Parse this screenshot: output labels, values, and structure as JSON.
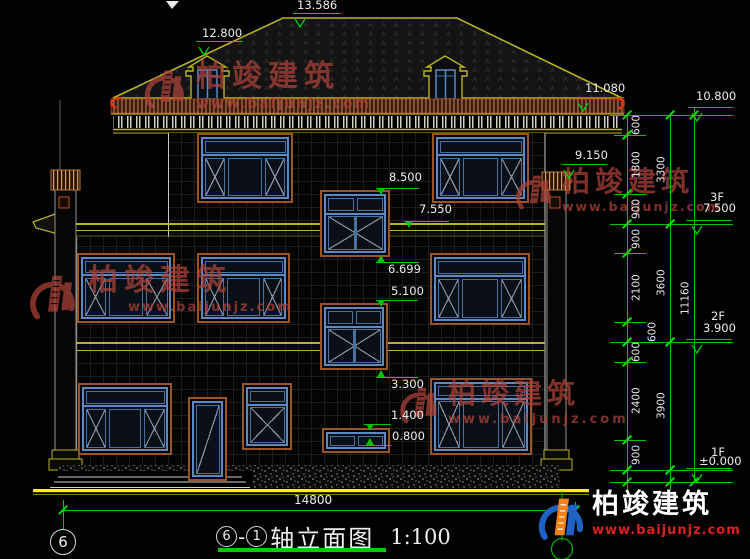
{
  "drawing": {
    "type": "architectural front elevation",
    "scale_note": "1:100"
  },
  "watermark": {
    "company": "柏竣建筑",
    "website": "www.baijunjz.com"
  },
  "logo": {
    "company": "柏竣建筑",
    "website": "www.baijunjz.com"
  },
  "title_block": {
    "axis_start": "6",
    "separator": "-",
    "axis_end": "1",
    "title": "轴立面图",
    "scale": "1:100"
  },
  "axis_bubble": {
    "label": "6"
  },
  "bottom_dimension": {
    "value": "14800"
  },
  "colors": {
    "dimension_green": "#00c400",
    "text_white": "#ededed",
    "band_yellow": "#b9b325",
    "ground_yellow": "#ffee00",
    "frame_brown": "#9a5526",
    "frame_blue": "#5d8ac2",
    "watermark_red": "#b04338",
    "fascia_red": "#d93511",
    "logo_orange": "#f28018",
    "logo_blue": "#1f62c4"
  },
  "elevation_labels": [
    {
      "value": "13.586",
      "tx": 297,
      "ty": 0,
      "x1": 293,
      "x2": 341,
      "y": 13,
      "mx": 300,
      "marker": "open"
    },
    {
      "value": "12.800",
      "tx": 202,
      "ty": 28,
      "x1": 196,
      "x2": 243,
      "y": 41,
      "mx": 204,
      "marker": "open"
    },
    {
      "value": "11.080",
      "tx": 585,
      "ty": 83,
      "x1": 576,
      "x2": 624,
      "y": 97,
      "mx": 583,
      "marker": "open"
    },
    {
      "value": "9.150",
      "tx": 575,
      "ty": 150,
      "x1": 562,
      "x2": 607,
      "y": 164,
      "mx": 569,
      "marker": "open"
    },
    {
      "value": "8.500",
      "tx": 389,
      "ty": 172,
      "x1": 376,
      "x2": 419,
      "y": 188,
      "mx": 381,
      "marker": "down"
    },
    {
      "value": "7.550",
      "tx": 419,
      "ty": 204,
      "x1": 404,
      "x2": 449,
      "y": 221,
      "mx": 409,
      "marker": "down"
    },
    {
      "value": "6.699",
      "tx": 388,
      "ty": 264,
      "x1": 376,
      "x2": 419,
      "y": 262,
      "mx": 381,
      "marker": "up"
    },
    {
      "value": "5.100",
      "tx": 391,
      "ty": 286,
      "x1": 376,
      "x2": 418,
      "y": 300,
      "mx": 381,
      "marker": "down"
    },
    {
      "value": "3.300",
      "tx": 391,
      "ty": 379,
      "x1": 376,
      "x2": 418,
      "y": 377,
      "mx": 381,
      "marker": "up"
    },
    {
      "value": "1.400",
      "tx": 391,
      "ty": 410,
      "x1": 364,
      "x2": 391,
      "y": 424,
      "mx": 370,
      "marker": "down"
    },
    {
      "value": "0.800",
      "tx": 392,
      "ty": 431,
      "x1": 364,
      "x2": 391,
      "y": 445,
      "mx": 370,
      "marker": "up"
    }
  ],
  "level_markers": [
    {
      "floor": "",
      "value": "10.800",
      "fx": 0,
      "fy": 0,
      "tx": 696,
      "ty": 91,
      "x1": 688,
      "x2": 733,
      "y": 107,
      "mx": 697
    },
    {
      "floor": "3F",
      "value": "7.500",
      "fx": 710,
      "fy": 190,
      "tx": 703,
      "ty": 203,
      "x1": 686,
      "x2": 732,
      "y": 220,
      "mx": 697
    },
    {
      "floor": "2F",
      "value": "3.900",
      "fx": 711,
      "fy": 309,
      "tx": 703,
      "ty": 323,
      "x1": 686,
      "x2": 732,
      "y": 339,
      "mx": 697
    },
    {
      "floor": "1F",
      "value": "±0.000",
      "fx": 711,
      "fy": 445,
      "tx": 699,
      "ty": 456,
      "x1": 686,
      "x2": 732,
      "y": 468,
      "mx": 697
    }
  ],
  "floor_lines": [
    115,
    224,
    342,
    470,
    482
  ],
  "dimension_chains": [
    {
      "x": 627,
      "label_x": 630,
      "top": 115,
      "bottom": 490,
      "segments": [
        {
          "label": "600",
          "y1": 115,
          "y2": 135
        },
        {
          "label": "1800",
          "y1": 135,
          "y2": 194
        },
        {
          "label": "900",
          "y1": 194,
          "y2": 224
        },
        {
          "label": "900",
          "y1": 224,
          "y2": 253
        },
        {
          "label": "2100",
          "y1": 253,
          "y2": 322
        },
        {
          "label": "600",
          "y1": 322,
          "y2": 342,
          "lx": 646
        },
        {
          "label": "600",
          "y1": 342,
          "y2": 362
        },
        {
          "label": "2400",
          "y1": 362,
          "y2": 440
        },
        {
          "label": "900",
          "y1": 440,
          "y2": 470
        },
        {
          "label": "",
          "y1": 470,
          "y2": 482
        }
      ]
    },
    {
      "x": 670,
      "label_x": 655,
      "top": 115,
      "bottom": 490,
      "segments": [
        {
          "label": "3300",
          "y1": 115,
          "y2": 224
        },
        {
          "label": "3600",
          "y1": 224,
          "y2": 342
        },
        {
          "label": "3900",
          "y1": 342,
          "y2": 470
        },
        {
          "label": "",
          "y1": 470,
          "y2": 482
        }
      ]
    },
    {
      "x": 694,
      "label_x": 679,
      "top": 107,
      "bottom": 482,
      "segments": [
        {
          "label": "11160",
          "y1": 115,
          "y2": 482
        }
      ]
    }
  ],
  "windows": [
    {
      "type": "std3",
      "x": 197,
      "y": 133,
      "w": 96,
      "h": 70
    },
    {
      "type": "std3",
      "x": 432,
      "y": 133,
      "w": 97,
      "h": 70
    },
    {
      "type": "stair",
      "x": 320,
      "y": 190,
      "w": 70,
      "h": 67
    },
    {
      "type": "std3",
      "x": 77,
      "y": 253,
      "w": 98,
      "h": 70
    },
    {
      "type": "std3",
      "x": 197,
      "y": 253,
      "w": 93,
      "h": 70
    },
    {
      "type": "std3",
      "x": 430,
      "y": 253,
      "w": 100,
      "h": 72
    },
    {
      "type": "stair",
      "x": 320,
      "y": 303,
      "w": 68,
      "h": 67
    },
    {
      "type": "std3",
      "x": 78,
      "y": 383,
      "w": 94,
      "h": 72
    },
    {
      "type": "single",
      "x": 242,
      "y": 383,
      "w": 50,
      "h": 67
    },
    {
      "type": "tall3",
      "x": 430,
      "y": 378,
      "w": 102,
      "h": 77
    },
    {
      "type": "smallh",
      "x": 322,
      "y": 428,
      "w": 68,
      "h": 25
    },
    {
      "type": "door",
      "x": 188,
      "y": 397,
      "w": 39,
      "h": 84
    }
  ]
}
